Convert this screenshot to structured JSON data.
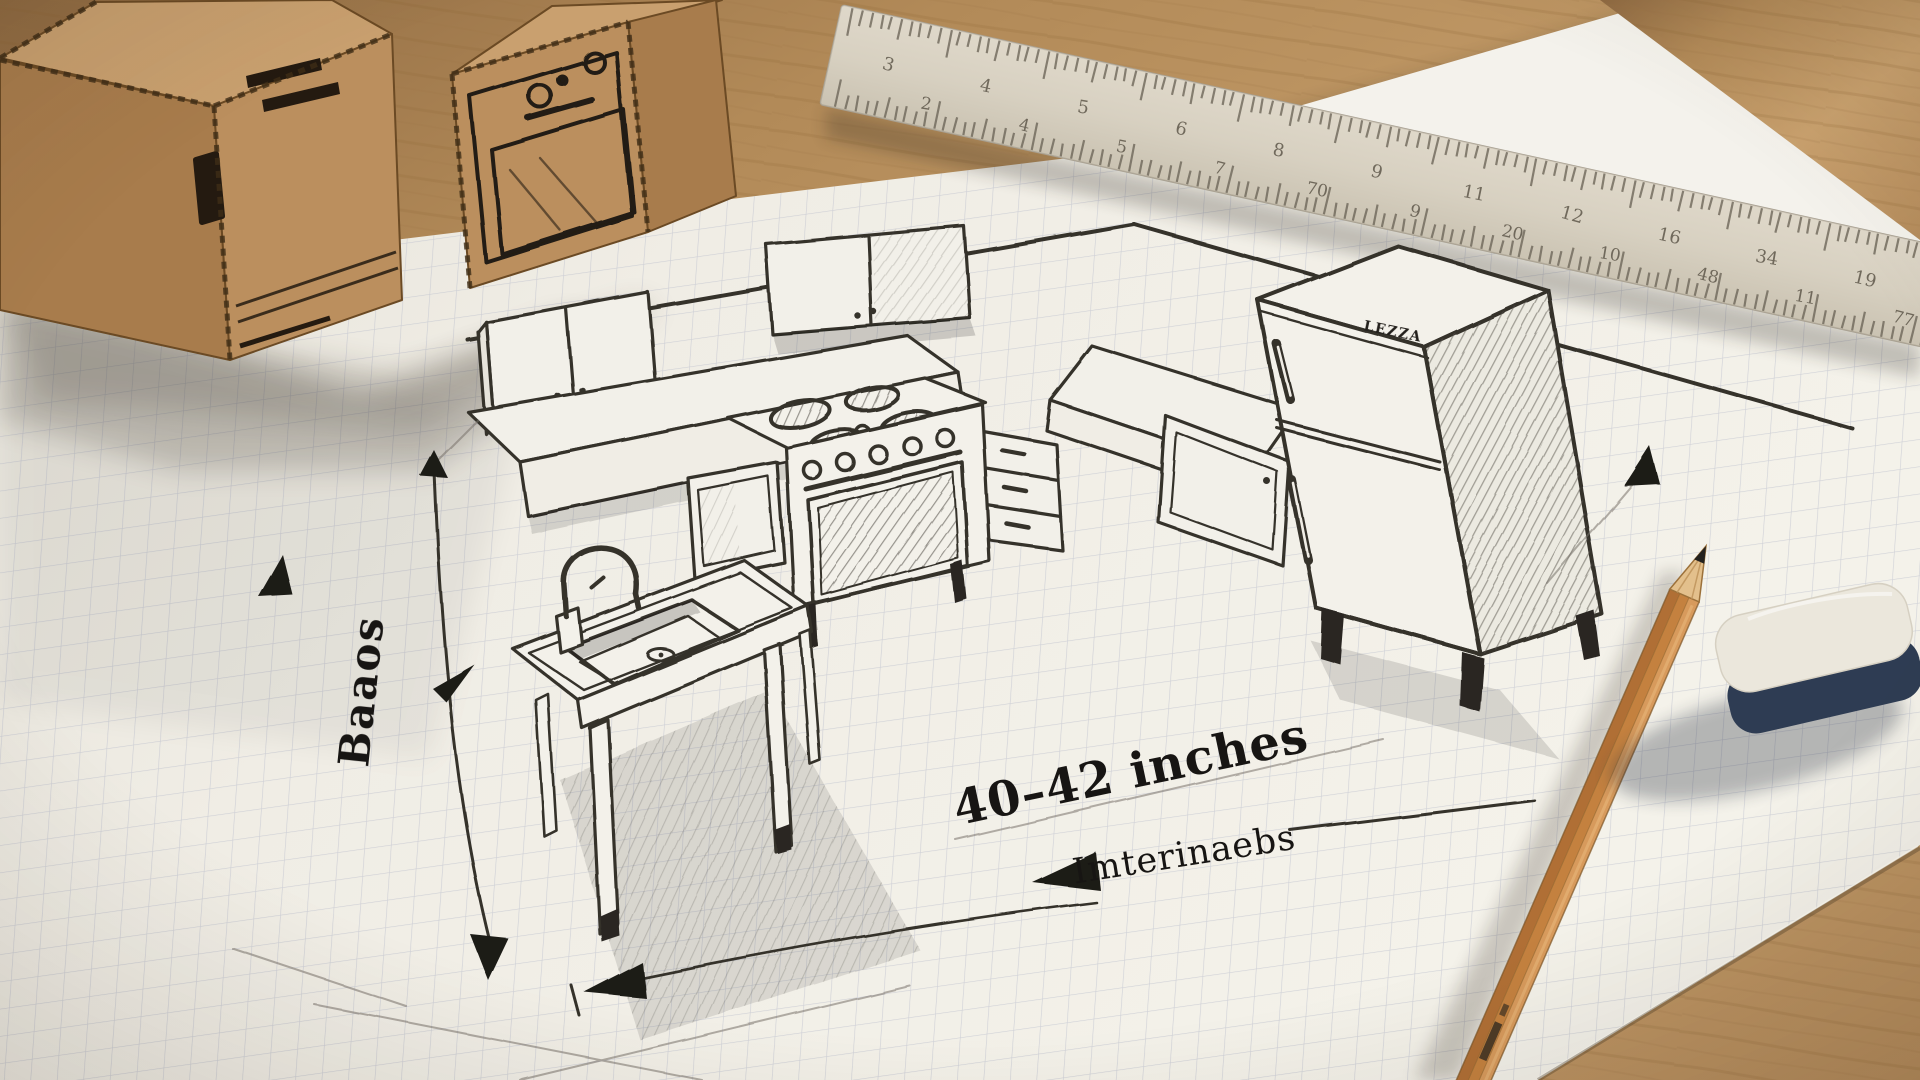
{
  "labels": {
    "dimension": "40–42 inches",
    "underline_note": "Imterinaebs",
    "vertical_note": "Baaos",
    "fridge_brand": "LEZZA"
  },
  "ruler": {
    "scale_top": [
      "3",
      "4",
      "5",
      "6",
      "8",
      "9",
      "11",
      "12",
      "16",
      "34",
      "19"
    ],
    "scale_bottom": [
      "2",
      "4",
      "5",
      "7",
      "70",
      "9",
      "20",
      "10",
      "48",
      "11",
      "77"
    ]
  },
  "colors": {
    "wood": "#bb9265",
    "wood_light": "#cfae80",
    "paper": "#f0ede5",
    "plain_sheet": "#f4f2ec",
    "grid_line": "#b9bdcc",
    "pencil_line": "#34312c",
    "cardboard": "#bb8f5e",
    "cardboard_side": "#a87c4c",
    "cardboard_top": "#c9a06f",
    "ruler_body": "#d9d2c3",
    "pencil_wood": "#c4813f",
    "eraser_top": "#ebe7dc",
    "eraser_base": "#2e3c53"
  }
}
